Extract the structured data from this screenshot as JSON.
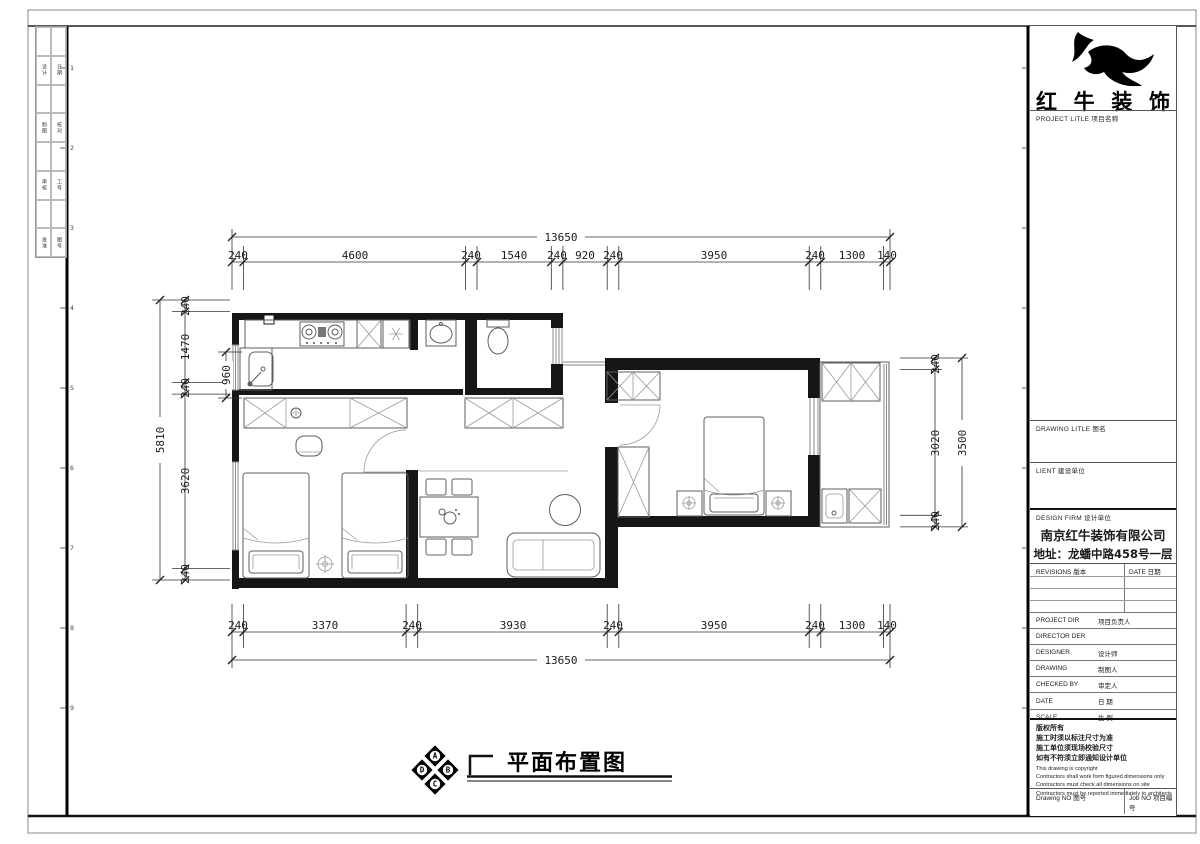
{
  "sheet": {
    "frame_rows": [
      "1",
      "2",
      "3",
      "4",
      "5",
      "6",
      "7",
      "8",
      "9"
    ],
    "margin_rows": [
      [
        "设计",
        "日期"
      ],
      [
        "制图",
        "校对"
      ],
      [
        "审核",
        "工号"
      ],
      [
        "批准",
        "图号"
      ]
    ]
  },
  "brand": {
    "name_spaced": [
      "红",
      "牛",
      "装",
      "饰"
    ]
  },
  "titleblock": {
    "project_label": "PROJECT LITLE  项目名称",
    "drawing_label": "DRAWING LITLE  图名",
    "client_label": "LIENT  建设单位",
    "firm_label": "DESIGN FIRM  设计单位",
    "company_name": "南京红牛装饰有限公司",
    "company_address": "地址：龙蟠中路458号一层",
    "revisions_label": "REVISIONS  版本",
    "date_col_label": "DATE  日期",
    "rows": [
      {
        "en": "PROJECT DIR",
        "cn": "项目负责人"
      },
      {
        "en": "DIRECTOR DER",
        "cn": ""
      },
      {
        "en": "DESIGNER",
        "cn": "设计师"
      },
      {
        "en": "DRAWING",
        "cn": "制图人"
      },
      {
        "en": "CHECKED BY",
        "cn": "审定人"
      },
      {
        "en": "DATE",
        "cn": "日 期"
      },
      {
        "en": "SCALE",
        "cn": "比 例"
      }
    ],
    "copyright": [
      "版权所有",
      "施工时须以标注尺寸为准",
      "施工单位须现场校验尺寸",
      "如有不符须立即通知设计单位",
      "This drawing is copyright",
      "Contractors shall work form figured dimensions only",
      "Contractors must check all dimensions on site",
      "Contractors must be reported immediately to architects"
    ],
    "drawing_no_label": "Drawing NO  图号",
    "job_no_label": "Job NO  项目编号"
  },
  "plan": {
    "title": "平面布置图",
    "compass": {
      "top": "A",
      "right": "B",
      "bottom": "C",
      "left": "D"
    }
  },
  "dims": {
    "top_total": "13650",
    "top_chain": [
      "240",
      "4600",
      "240",
      "1540",
      "240",
      "920",
      "240",
      "3950",
      "240",
      "1300",
      "140"
    ],
    "bottom_total": "13650",
    "bottom_chain": [
      "240",
      "3370",
      "240",
      "3930",
      "240",
      "3950",
      "240",
      "1300",
      "140"
    ],
    "left_total": "5810",
    "left_chain": [
      "240",
      "1470",
      "240",
      "3620",
      "240"
    ],
    "left_inner": "960",
    "right_total": "3500",
    "right_chain": [
      "240",
      "3020",
      "240"
    ]
  }
}
